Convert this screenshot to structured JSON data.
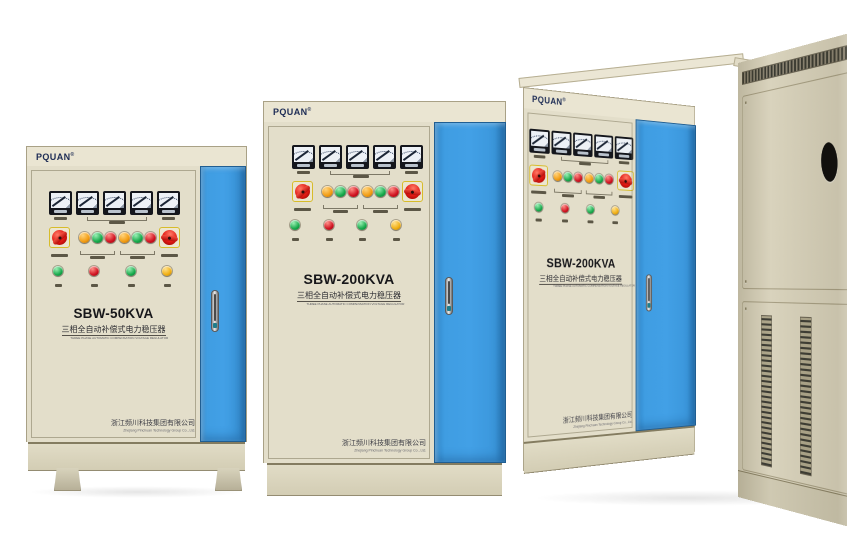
{
  "brand": {
    "logo": "PQUAN",
    "reg": "®"
  },
  "labels": {
    "subtitle_cn": "三相全自动补偿式电力稳压器",
    "subtitle_en": "THREE PHASE AUTOMATIC COMPENSATION VOLTAGE REGULATOR",
    "company_cn": "浙江频川科技集团有限公司",
    "company_en": "Zhejiang Pinchuan Technology Group Co., Ltd."
  },
  "cabinets": [
    {
      "position": "left",
      "model": "SBW-50KVA"
    },
    {
      "position": "middle",
      "model": "SBW-200KVA"
    },
    {
      "position": "right",
      "model": "SBW-200KVA"
    }
  ],
  "panel": {
    "meter_count": 5,
    "rotary_knob_count": 2,
    "indicator_lights": [
      "orange",
      "green",
      "red",
      "orange",
      "green",
      "red"
    ],
    "status_lights": [
      "green",
      "red",
      "green",
      "yellow"
    ]
  },
  "colors": {
    "background": "#ffffff",
    "cabinet_body": "#e4dfca",
    "door_blue": "#3f9de2",
    "logo_navy": "#1d2c55",
    "knob_red": "#e01812",
    "light_orange": "#f29c12",
    "light_green": "#17a94b",
    "light_red": "#cf1220",
    "light_yellow": "#f0ae12",
    "meter_bezel": "#14161c"
  }
}
